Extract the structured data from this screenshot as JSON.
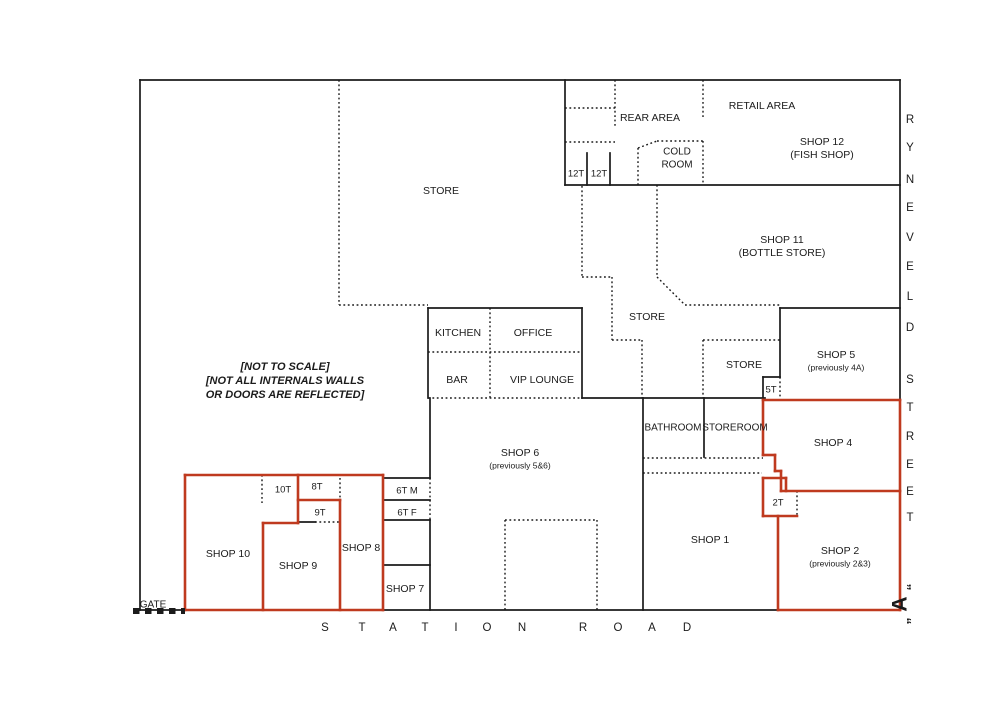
{
  "title": "Shop layout plan - Station Road / Ryneveld Street",
  "canvas": {
    "width": 1000,
    "height": 707
  },
  "colors": {
    "background": "#ffffff",
    "wall": "#1b1b1b",
    "highlight": "#bf3a1f",
    "text": "#1b1b1b"
  },
  "note": {
    "x": 285,
    "lines": [
      {
        "text": "[NOT TO SCALE]",
        "y": 367
      },
      {
        "text": "[NOT ALL INTERNALS WALLS",
        "y": 381
      },
      {
        "text": "OR DOORS ARE REFLECTED]",
        "y": 395
      }
    ]
  },
  "streets": {
    "right": {
      "name": "RYNEVELD STREET",
      "x": 910,
      "letters": [
        {
          "ch": "R",
          "y": 120
        },
        {
          "ch": "Y",
          "y": 148
        },
        {
          "ch": "N",
          "y": 180
        },
        {
          "ch": "E",
          "y": 208
        },
        {
          "ch": "V",
          "y": 238
        },
        {
          "ch": "E",
          "y": 267
        },
        {
          "ch": "L",
          "y": 297
        },
        {
          "ch": "D",
          "y": 328
        },
        {
          "ch": "S",
          "y": 380
        },
        {
          "ch": "T",
          "y": 408
        },
        {
          "ch": "R",
          "y": 437
        },
        {
          "ch": "E",
          "y": 465
        },
        {
          "ch": "E",
          "y": 492
        },
        {
          "ch": "T",
          "y": 518
        }
      ]
    },
    "bottom": {
      "name": "STATION ROAD",
      "y": 628,
      "letters": [
        {
          "ch": "S",
          "x": 325
        },
        {
          "ch": "T",
          "x": 362
        },
        {
          "ch": "A",
          "x": 393
        },
        {
          "ch": "T",
          "x": 425
        },
        {
          "ch": "I",
          "x": 456
        },
        {
          "ch": "O",
          "x": 487
        },
        {
          "ch": "N",
          "x": 522
        },
        {
          "ch": "R",
          "x": 583
        },
        {
          "ch": "O",
          "x": 618
        },
        {
          "ch": "A",
          "x": 652
        },
        {
          "ch": "D",
          "x": 687
        }
      ]
    }
  },
  "marker_a": {
    "letter": "A",
    "open_quote": "“",
    "close_quote": "”",
    "x": 901,
    "y": 604
  },
  "gate": {
    "label": "GATE",
    "x1": 133,
    "y1": 611,
    "x2": 185,
    "y2": 611
  },
  "walls": {
    "solid": [
      [
        140,
        80,
        900,
        80
      ],
      [
        900,
        80,
        900,
        610
      ],
      [
        140,
        610,
        900,
        610
      ],
      [
        140,
        80,
        140,
        610
      ],
      [
        565,
        80,
        565,
        185
      ],
      [
        565,
        185,
        900,
        185
      ],
      [
        587,
        153,
        587,
        185
      ],
      [
        610,
        153,
        610,
        185
      ],
      [
        428,
        308,
        582,
        308
      ],
      [
        582,
        308,
        582,
        398
      ],
      [
        428,
        308,
        428,
        398
      ],
      [
        582,
        398,
        765,
        398
      ],
      [
        643,
        398,
        643,
        610
      ],
      [
        704,
        398,
        704,
        457
      ],
      [
        780,
        308,
        900,
        308
      ],
      [
        780,
        308,
        780,
        377
      ],
      [
        763,
        377,
        780,
        377
      ],
      [
        763,
        377,
        763,
        398
      ],
      [
        430,
        398,
        430,
        478
      ],
      [
        430,
        520,
        430,
        610
      ],
      [
        383,
        478,
        430,
        478
      ],
      [
        383,
        500,
        430,
        500
      ],
      [
        383,
        520,
        430,
        520
      ],
      [
        383,
        565,
        430,
        565
      ],
      [
        298,
        522,
        315,
        522
      ]
    ],
    "dotted": [
      [
        339,
        80,
        339,
        305
      ],
      [
        339,
        305,
        428,
        305
      ],
      [
        615,
        80,
        615,
        128
      ],
      [
        565,
        108,
        615,
        108
      ],
      [
        565,
        142,
        615,
        142
      ],
      [
        703,
        80,
        703,
        118
      ],
      [
        638,
        148,
        638,
        185
      ],
      [
        638,
        148,
        657,
        141
      ],
      [
        657,
        141,
        703,
        141
      ],
      [
        703,
        141,
        703,
        185
      ],
      [
        582,
        186,
        582,
        277
      ],
      [
        582,
        277,
        612,
        277
      ],
      [
        612,
        277,
        612,
        340
      ],
      [
        612,
        340,
        642,
        340
      ],
      [
        642,
        340,
        642,
        398
      ],
      [
        657,
        185,
        657,
        277
      ],
      [
        657,
        277,
        685,
        305
      ],
      [
        685,
        305,
        780,
        305
      ],
      [
        703,
        340,
        780,
        340
      ],
      [
        703,
        340,
        703,
        398
      ],
      [
        780,
        377,
        780,
        398
      ],
      [
        490,
        308,
        490,
        398
      ],
      [
        428,
        352,
        582,
        352
      ],
      [
        428,
        398,
        582,
        398
      ],
      [
        643,
        458,
        763,
        458
      ],
      [
        643,
        473,
        762,
        473
      ],
      [
        505,
        520,
        505,
        610
      ],
      [
        505,
        520,
        597,
        520
      ],
      [
        597,
        520,
        597,
        610
      ],
      [
        262,
        475,
        262,
        503
      ],
      [
        340,
        478,
        340,
        500
      ],
      [
        315,
        522,
        340,
        522
      ],
      [
        430,
        478,
        430,
        520
      ],
      [
        797,
        491,
        797,
        516
      ]
    ],
    "red": [
      [
        185,
        475,
        383,
        475
      ],
      [
        383,
        475,
        383,
        610
      ],
      [
        185,
        610,
        383,
        610
      ],
      [
        185,
        475,
        185,
        610
      ],
      [
        298,
        475,
        298,
        523
      ],
      [
        298,
        500,
        340,
        500
      ],
      [
        340,
        500,
        340,
        610
      ],
      [
        263,
        523,
        298,
        523
      ],
      [
        263,
        523,
        263,
        610
      ],
      [
        763,
        400,
        900,
        400
      ],
      [
        900,
        400,
        900,
        610
      ],
      [
        781,
        491,
        900,
        491
      ],
      [
        763,
        400,
        763,
        455
      ],
      [
        763,
        455,
        775,
        455
      ],
      [
        775,
        455,
        775,
        471
      ],
      [
        775,
        471,
        781,
        471
      ],
      [
        781,
        471,
        781,
        491
      ],
      [
        763,
        478,
        786,
        478
      ],
      [
        763,
        478,
        763,
        516
      ],
      [
        763,
        516,
        797,
        516
      ],
      [
        786,
        478,
        786,
        491
      ],
      [
        778,
        516,
        778,
        610
      ],
      [
        778,
        610,
        900,
        610
      ]
    ]
  },
  "labels": [
    {
      "id": "rear-area",
      "text": "REAR AREA",
      "x": 650,
      "y": 118,
      "size": 10.5
    },
    {
      "id": "retail-area",
      "text": "RETAIL AREA",
      "x": 762,
      "y": 106,
      "size": 10.5
    },
    {
      "id": "shop-12",
      "text": "SHOP 12",
      "x": 822,
      "y": 142,
      "size": 10.5
    },
    {
      "id": "shop-12-sub",
      "text": "(FISH SHOP)",
      "x": 822,
      "y": 155,
      "size": 10.5
    },
    {
      "id": "cold-room-1",
      "text": "COLD",
      "x": 677,
      "y": 152,
      "size": 10
    },
    {
      "id": "cold-room-2",
      "text": "ROOM",
      "x": 677,
      "y": 165,
      "size": 10
    },
    {
      "id": "toilet-12t-a",
      "text": "12T",
      "x": 576,
      "y": 174,
      "size": 9.5
    },
    {
      "id": "toilet-12t-b",
      "text": "12T",
      "x": 599,
      "y": 174,
      "size": 9.5
    },
    {
      "id": "store-main",
      "text": "STORE",
      "x": 441,
      "y": 191,
      "size": 10.5
    },
    {
      "id": "shop-11",
      "text": "SHOP 11",
      "x": 782,
      "y": 240,
      "size": 10.5
    },
    {
      "id": "shop-11-sub",
      "text": "(BOTTLE STORE)",
      "x": 782,
      "y": 253,
      "size": 10.5
    },
    {
      "id": "store-mid",
      "text": "STORE",
      "x": 647,
      "y": 317,
      "size": 10.5
    },
    {
      "id": "kitchen",
      "text": "KITCHEN",
      "x": 458,
      "y": 333,
      "size": 10.5
    },
    {
      "id": "office",
      "text": "OFFICE",
      "x": 533,
      "y": 333,
      "size": 10.5
    },
    {
      "id": "bar",
      "text": "BAR",
      "x": 457,
      "y": 380,
      "size": 10.5
    },
    {
      "id": "vip-lounge",
      "text": "VIP LOUNGE",
      "x": 542,
      "y": 380,
      "size": 10.5
    },
    {
      "id": "store-right",
      "text": "STORE",
      "x": 744,
      "y": 365,
      "size": 10.5
    },
    {
      "id": "toilet-5t",
      "text": "5T",
      "x": 771,
      "y": 390,
      "size": 9.5
    },
    {
      "id": "shop-5",
      "text": "SHOP 5",
      "x": 836,
      "y": 355,
      "size": 10.5
    },
    {
      "id": "shop-5-sub",
      "text": "(previously 4A)",
      "x": 836,
      "y": 368,
      "size": 8.5
    },
    {
      "id": "bathroom",
      "text": "BATHROOM",
      "x": 673,
      "y": 428,
      "size": 10
    },
    {
      "id": "storeroom",
      "text": "STOREROOM",
      "x": 735,
      "y": 428,
      "size": 10
    },
    {
      "id": "shop-4",
      "text": "SHOP 4",
      "x": 833,
      "y": 443,
      "size": 10.5
    },
    {
      "id": "shop-6",
      "text": "SHOP 6",
      "x": 520,
      "y": 453,
      "size": 10.5
    },
    {
      "id": "shop-6-sub",
      "text": "(previously 5&6)",
      "x": 520,
      "y": 466,
      "size": 8.5
    },
    {
      "id": "toilet-2t",
      "text": "2T",
      "x": 778,
      "y": 503,
      "size": 9.5
    },
    {
      "id": "shop-1",
      "text": "SHOP 1",
      "x": 710,
      "y": 540,
      "size": 10.5
    },
    {
      "id": "shop-2",
      "text": "SHOP 2",
      "x": 840,
      "y": 551,
      "size": 10.5
    },
    {
      "id": "shop-2-sub",
      "text": "(previously 2&3)",
      "x": 840,
      "y": 564,
      "size": 8.5
    },
    {
      "id": "toilet-10t",
      "text": "10T",
      "x": 283,
      "y": 490,
      "size": 9.5
    },
    {
      "id": "toilet-8t",
      "text": "8T",
      "x": 317,
      "y": 487,
      "size": 9.5
    },
    {
      "id": "toilet-9t",
      "text": "9T",
      "x": 320,
      "y": 513,
      "size": 9.5
    },
    {
      "id": "shop-10",
      "text": "SHOP 10",
      "x": 228,
      "y": 554,
      "size": 10.5
    },
    {
      "id": "shop-9",
      "text": "SHOP 9",
      "x": 298,
      "y": 566,
      "size": 10.5
    },
    {
      "id": "shop-8",
      "text": "SHOP 8",
      "x": 361,
      "y": 548,
      "size": 10.5
    },
    {
      "id": "toilet-6t-m",
      "text": "6T M",
      "x": 407,
      "y": 491,
      "size": 9.5
    },
    {
      "id": "toilet-6t-f",
      "text": "6T F",
      "x": 407,
      "y": 513,
      "size": 9.5
    },
    {
      "id": "shop-7",
      "text": "SHOP 7",
      "x": 405,
      "y": 589,
      "size": 10.5
    },
    {
      "id": "gate-label",
      "text": "GATE",
      "x": 153,
      "y": 605,
      "size": 10
    }
  ]
}
